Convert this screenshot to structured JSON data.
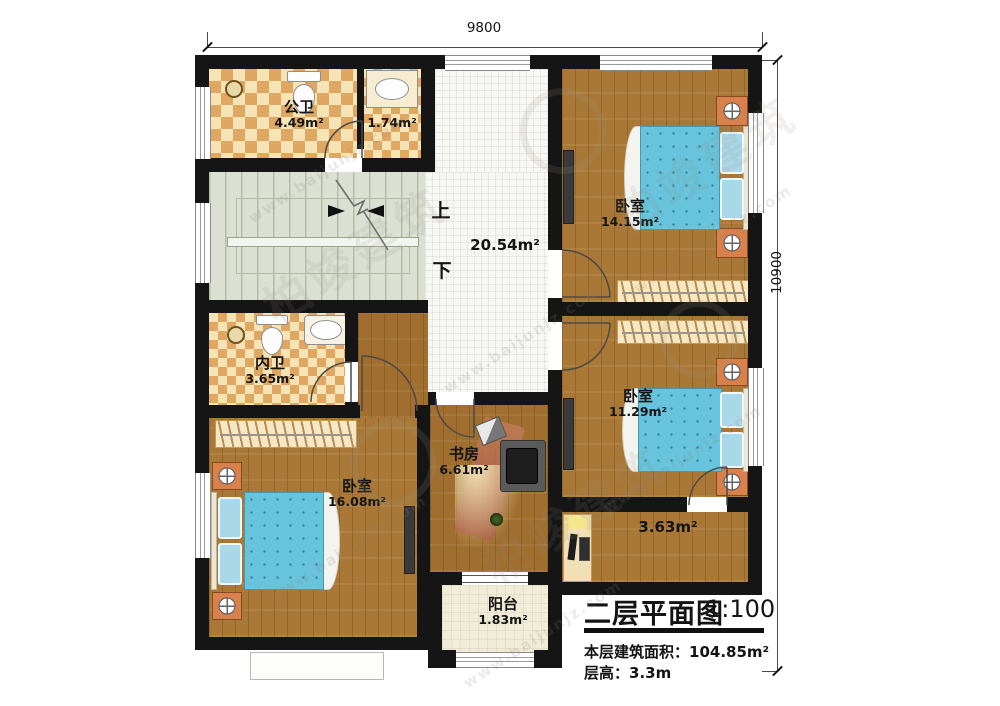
{
  "plan": {
    "dimensions": {
      "top": "9800",
      "right": "10900"
    },
    "stairs": {
      "up": "上",
      "down": "下"
    },
    "rooms": [
      {
        "name": "公卫",
        "area": "4.49m²"
      },
      {
        "name": "",
        "area": "1.74m²"
      },
      {
        "name": "",
        "area": "20.54m²"
      },
      {
        "name": "卧室",
        "area": "14.15m²"
      },
      {
        "name": "内卫",
        "area": "3.65m²"
      },
      {
        "name": "卧室",
        "area": "16.08m²"
      },
      {
        "name": "书房",
        "area": "6.61m²"
      },
      {
        "name": "卧室",
        "area": "11.29m²"
      },
      {
        "name": "",
        "area": "3.63m²"
      },
      {
        "name": "阳台",
        "area": "1.83m²"
      }
    ],
    "title_block": {
      "title": "二层平面图",
      "scale": "1:100",
      "area_label": "本层建筑面积：",
      "area_value": "104.85m²",
      "height_label": "层高：",
      "height_value": "3.3m"
    },
    "watermark": {
      "brand": "柏竣建筑",
      "url": "www.baijunjz.com"
    }
  }
}
